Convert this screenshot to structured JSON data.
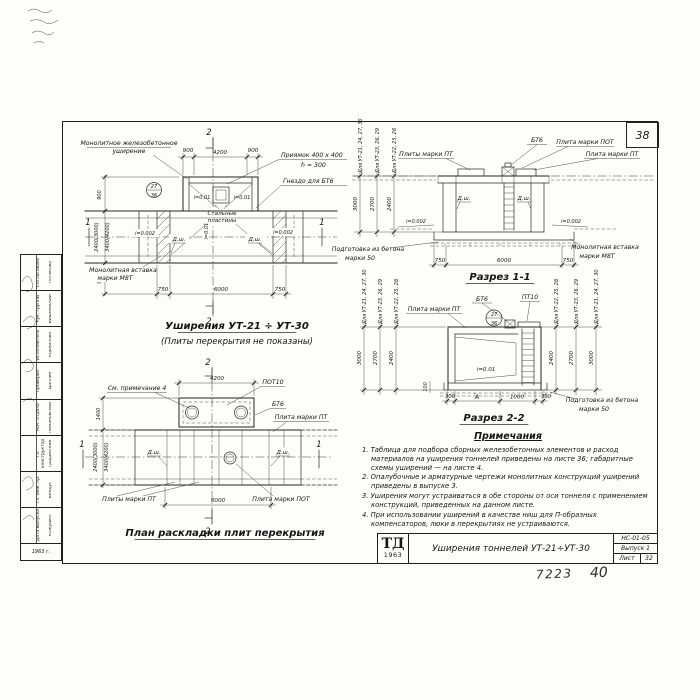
{
  "sheet": {
    "corner_number": "38",
    "pencil_left": "7223",
    "pencil_right": "40"
  },
  "stamp": {
    "logo_top": "ТД",
    "logo_year": "1963",
    "title": "Уширения тоннелей УТ-21÷УТ-30",
    "code": "НС-01-05",
    "issue": "Выпуск 1",
    "sheet_label": "Лист",
    "sheet_number": "32"
  },
  "sig_strip": {
    "year": "1963 г.",
    "rows": [
      {
        "role": "Согласовано",
        "name": "Полякова"
      },
      {
        "role": "Рук. группы",
        "name": "Вишневский"
      },
      {
        "role": "Исполнитель",
        "name": "Корнилова"
      },
      {
        "role": "Проверил",
        "name": "Цаплин"
      },
      {
        "role": "Нач. отдела",
        "name": "Лимановский"
      },
      {
        "role": "Гл. конструктор",
        "name": "Градинский"
      },
      {
        "role": "Гл. инж. пр.",
        "name": "Бендус"
      },
      {
        "role": "Дата выпуска",
        "name": "Кожушко"
      }
    ]
  },
  "plan_top": {
    "title": "Уширения УТ-21 ÷ УТ-30",
    "subtitle": "(Плиты перекрытия не показаны)",
    "label_widening_1": "Монолитное железобетонное",
    "label_widening_2": "уширение",
    "label_pit_1": "Приямок 400 х 400",
    "label_pit_2": "h = 300",
    "label_socket": "Гнездо для БТ6",
    "label_plates_1": "Стальные",
    "label_plates_2": "пластины",
    "label_insert_1": "Монолитная вставка",
    "label_insert_2": "марки М8Т",
    "dims_top": [
      "900",
      "4200",
      "900"
    ],
    "dims_bottom": [
      "750",
      "6000",
      "750"
    ],
    "dims_left": [
      "900",
      "2400(3000)",
      "3400(4200)",
      "900"
    ],
    "slope_pit": "i=0.01",
    "slope_axis": "i=0.01",
    "slope_floor": "i=0.002",
    "joint": "Д.ш.",
    "marker_1": "1",
    "marker_2": "2",
    "detail_top": "27",
    "detail_bottom": "36"
  },
  "section1": {
    "title": "Разрез 1-1",
    "label_bt6": "БТ6",
    "label_pot": "Плита марки ПОТ",
    "label_pt_left": "Плиты марки ПТ",
    "label_pt_right": "Плита марки ПТ",
    "label_prep_1": "Подготовка из бетона",
    "label_prep_2": "марки 50",
    "label_insert_1": "Монолитная вставка",
    "label_insert_2": "марки М8Т",
    "dims_bottom": [
      "750",
      "6000",
      "750"
    ],
    "joint": "Д.ш.",
    "slope": "i=0.002",
    "heights": [
      {
        "for": "Для УТ-21, 24, 27, 30",
        "value": "3000"
      },
      {
        "for": "Для УТ-23, 26, 29",
        "value": "2700"
      },
      {
        "for": "Для УТ-22, 25, 28",
        "value": "2400"
      }
    ]
  },
  "section2": {
    "title": "Разрез 2-2",
    "label_pt": "Плита марки ПТ",
    "label_bt6": "БТ6",
    "label_pt10": "ПТ10",
    "label_prep_1": "Подготовка из бетона",
    "label_prep_2": "марки 50",
    "slope": "i=0.01",
    "dims_bottom": [
      "300",
      "А",
      "1000",
      "300"
    ],
    "dim_small": "100",
    "detail_top": "27",
    "detail_bottom": "36",
    "heights_left": [
      {
        "for": "Для УТ-21, 24, 27, 30",
        "value": "3000"
      },
      {
        "for": "Для УТ-23, 26, 29",
        "value": "2700"
      },
      {
        "for": "Для УТ-22, 25, 28",
        "value": "2400"
      }
    ],
    "heights_right": [
      {
        "for": "Для УТ-22, 25, 28",
        "value": "2400"
      },
      {
        "for": "Для УТ-23, 26, 29",
        "value": "2700"
      },
      {
        "for": "Для УТ-21, 24, 27, 30",
        "value": "3000"
      }
    ]
  },
  "plan_bottom": {
    "title": "План раскладки плит перекрытия",
    "label_note": "См. примечание 4",
    "label_pot10": "ПОТ10",
    "label_bt6": "БТ6",
    "label_pt": "Плита марки ПТ",
    "label_pts": "Плиты марки ПТ",
    "label_pot": "Плита марки ПОТ",
    "dim_top": "4200",
    "dim_bottom": "6000",
    "dims_left": [
      "1400",
      "2400(3000)",
      "3400(4200)"
    ],
    "joint": "Д.ш.",
    "marker_1": "1",
    "marker_2": "2"
  },
  "notes": {
    "title": "Примечания",
    "items": [
      "1. Таблица для подбора сборных железобетонных элементов и расход материалов на уширения тоннелей приведены на листе 36; габаритные схемы уширений — на листе 4.",
      "2. Опалубочные и арматурные чертежи монолитных конструкций уширений приведены в выпуске 3.",
      "3. Уширения могут устраиваться в обе стороны от оси тоннеля с применением конструкций, приведенных на данном листе.",
      "4. При использовании уширений в качестве ниш для П-образных компенсаторов, люки в перекрытиях не устраиваются."
    ]
  }
}
